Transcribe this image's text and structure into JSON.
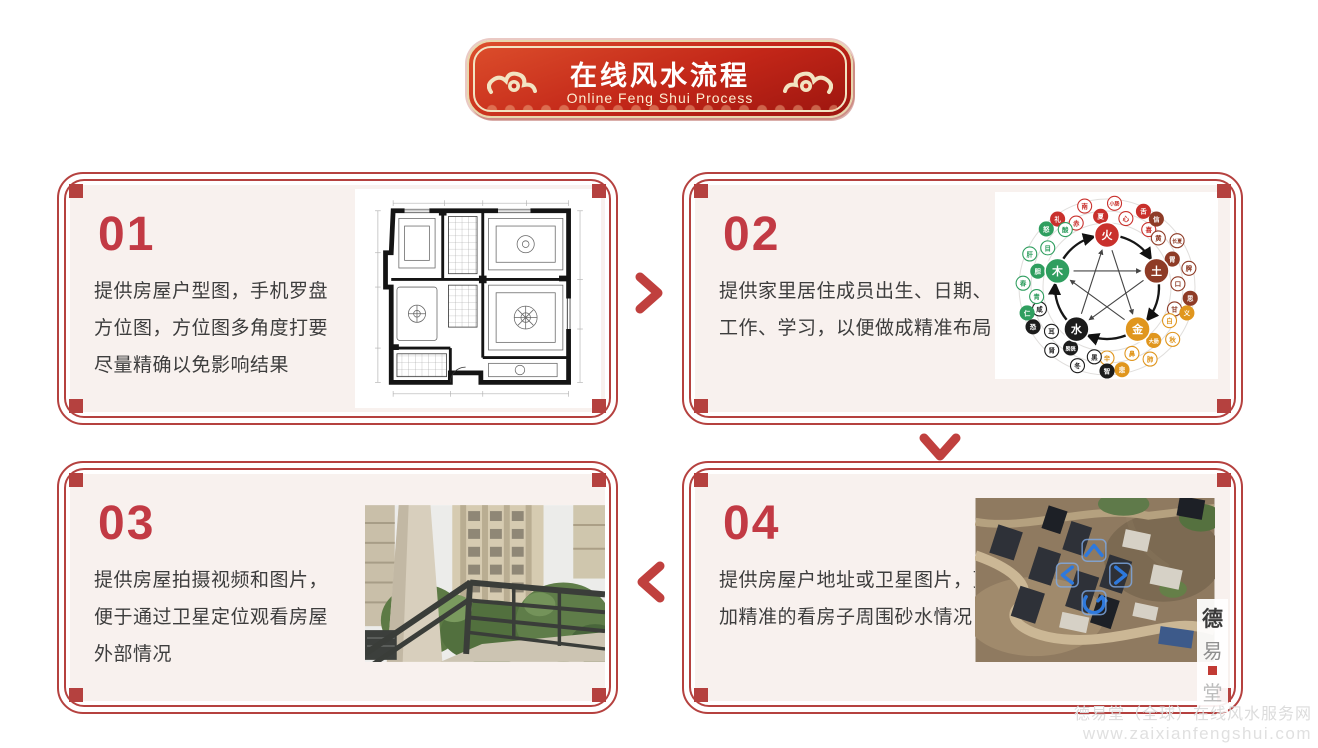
{
  "banner": {
    "title": "在线风水流程",
    "subtitle": "Online Feng Shui Process"
  },
  "steps": [
    {
      "number": "01",
      "text": "提供房屋户型图，手机罗盘方位图，方位图多角度打要尽量精确以免影响结果",
      "image": "floor-plan"
    },
    {
      "number": "02",
      "text": "提供家里居住成员出生、日期、工作、学习，以便做成精准布局",
      "image": "five-elements-diagram"
    },
    {
      "number": "03",
      "text": "提供房屋拍摄视频和图片，便于通过卫星定位观看房屋外部情况",
      "image": "balcony-photo"
    },
    {
      "number": "04",
      "text": "提供房屋户地址或卫星图片，更加精准的看房子周围砂水情况",
      "image": "satellite-photo"
    }
  ],
  "flow": {
    "step1_to_2": "arrow-right",
    "step2_to_4": "arrow-down",
    "step4_to_3": "arrow-left"
  },
  "five_elements": {
    "nodes": [
      {
        "id": "fire",
        "label": "火",
        "color": "#c9302c",
        "satellites": [
          "喜",
          "舌",
          "心",
          "小肠",
          "夏",
          "南",
          "赤",
          "礼"
        ]
      },
      {
        "id": "earth",
        "label": "土",
        "color": "#8e3b26",
        "satellites": [
          "甘",
          "思",
          "口",
          "脾",
          "胃",
          "长夏",
          "黄",
          "信"
        ]
      },
      {
        "id": "metal",
        "label": "金",
        "color": "#e0961e",
        "satellites": [
          "辛",
          "悲",
          "鼻",
          "肺",
          "大肠",
          "秋",
          "白",
          "义"
        ]
      },
      {
        "id": "water",
        "label": "水",
        "color": "#1c1c1c",
        "satellites": [
          "咸",
          "恐",
          "耳",
          "肾",
          "膀胱",
          "冬",
          "黑",
          "智"
        ]
      },
      {
        "id": "wood",
        "label": "木",
        "color": "#2f9e5f",
        "satellites": [
          "酸",
          "怒",
          "目",
          "肝",
          "胆",
          "春",
          "青",
          "仁"
        ]
      }
    ]
  },
  "stamp": {
    "chars": [
      "德",
      "易",
      "堂"
    ]
  },
  "footer": {
    "line1": "德易堂（全球）在线风水服务网",
    "line2": "www.zaixianfengshui.com"
  },
  "colors": {
    "frame_red": "#b5413f",
    "number_red": "#c23a44",
    "card_bg": "#f8f1ee",
    "banner_red": "#c22618",
    "banner_border_cream": "#f2e4c2",
    "text_dark": "#3d3d3d",
    "footer_gray": "#dcdcdc",
    "nav_arrow_blue": "#2e79dd"
  }
}
